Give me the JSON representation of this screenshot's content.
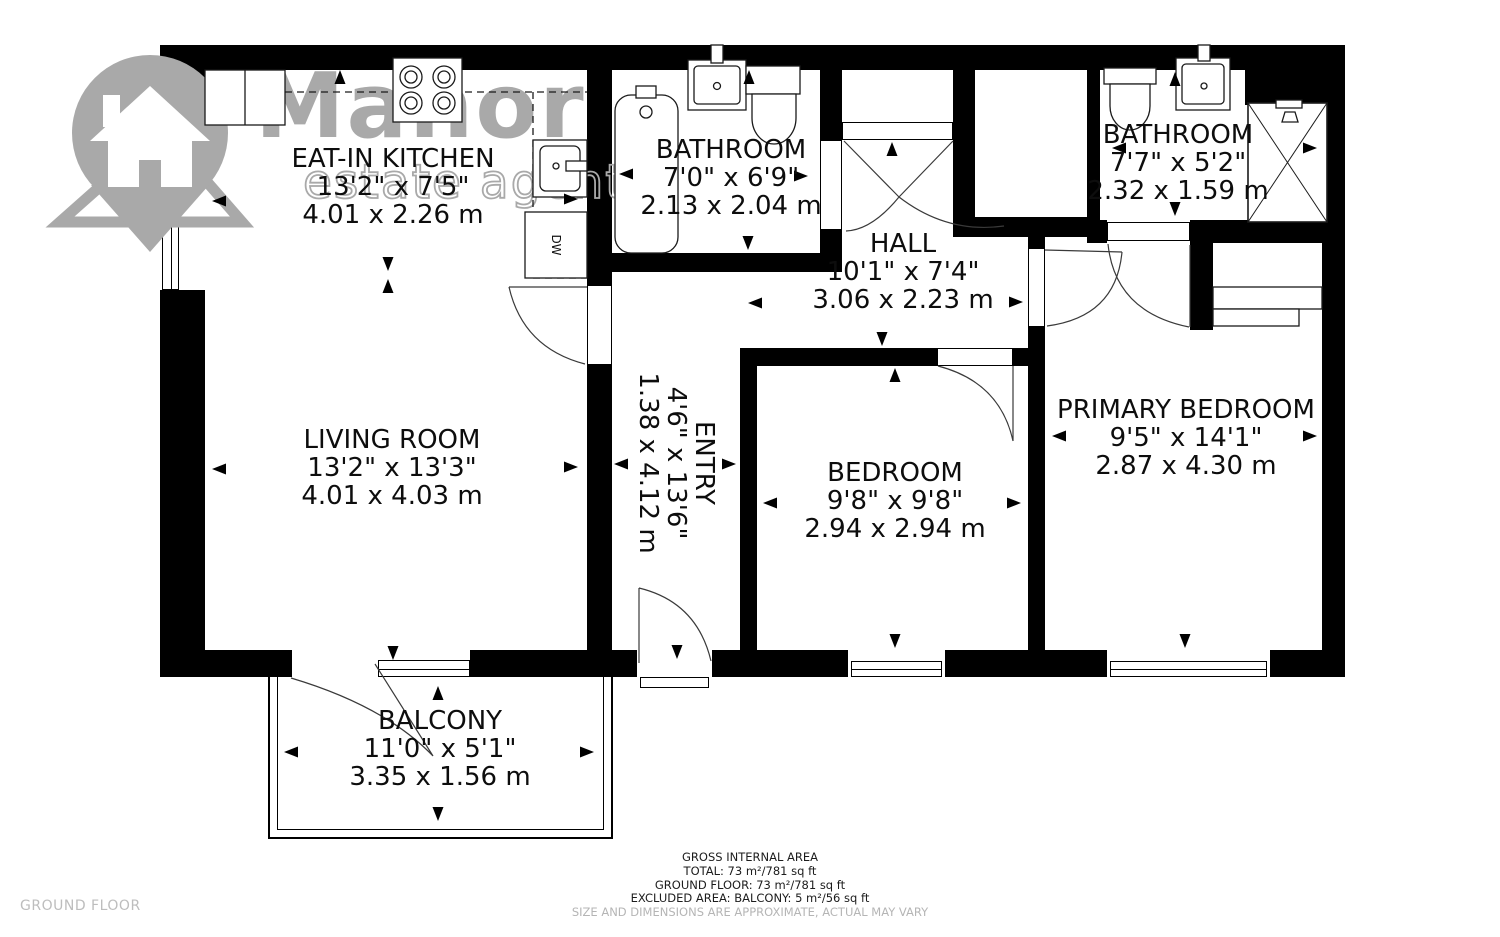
{
  "logo": {
    "brand": "Manor",
    "tagline": "estate agent"
  },
  "floor_label": "GROUND FLOOR",
  "rooms": [
    {
      "id": "eat-in-kitchen",
      "name": "EAT-IN KITCHEN",
      "imperial": "13'2\" x 7'5\"",
      "metric": "4.01 x 2.26 m"
    },
    {
      "id": "bathroom-1",
      "name": "BATHROOM",
      "imperial": "7'0\" x 6'9\"",
      "metric": "2.13 x 2.04 m"
    },
    {
      "id": "hall",
      "name": "HALL",
      "imperial": "10'1\" x 7'4\"",
      "metric": "3.06 x 2.23 m"
    },
    {
      "id": "bathroom-2",
      "name": "BATHROOM",
      "imperial": "7'7\" x 5'2\"",
      "metric": "2.32 x 1.59 m"
    },
    {
      "id": "living-room",
      "name": "LIVING ROOM",
      "imperial": "13'2\" x 13'3\"",
      "metric": "4.01 x 4.03 m"
    },
    {
      "id": "entry",
      "name": "ENTRY",
      "imperial": "4'6\" x 13'6\"",
      "metric": "1.38 x 4.12 m"
    },
    {
      "id": "bedroom",
      "name": "BEDROOM",
      "imperial": "9'8\" x 9'8\"",
      "metric": "2.94 x 2.94 m"
    },
    {
      "id": "primary-bedroom",
      "name": "PRIMARY BEDROOM",
      "imperial": "9'5\" x 14'1\"",
      "metric": "2.87 x 4.30 m"
    },
    {
      "id": "balcony",
      "name": "BALCONY",
      "imperial": "11'0\" x 5'1\"",
      "metric": "3.35 x 1.56 m"
    }
  ],
  "fixtures": {
    "dishwasher": "DW"
  },
  "footer": {
    "line1": "GROSS INTERNAL AREA",
    "line2": "TOTAL: 73 m²/781 sq ft",
    "line3": "GROUND FLOOR: 73 m²/781 sq ft",
    "line4": "EXCLUDED AREA: BALCONY: 5 m²/56 sq ft",
    "disclaimer": "SIZE AND DIMENSIONS ARE APPROXIMATE, ACTUAL MAY VARY"
  },
  "colors": {
    "wall": "#000000",
    "text": "#111111",
    "logo_gray": "#a9a9a9",
    "muted_text": "#b5b5b5",
    "floor": "#ffffff"
  }
}
